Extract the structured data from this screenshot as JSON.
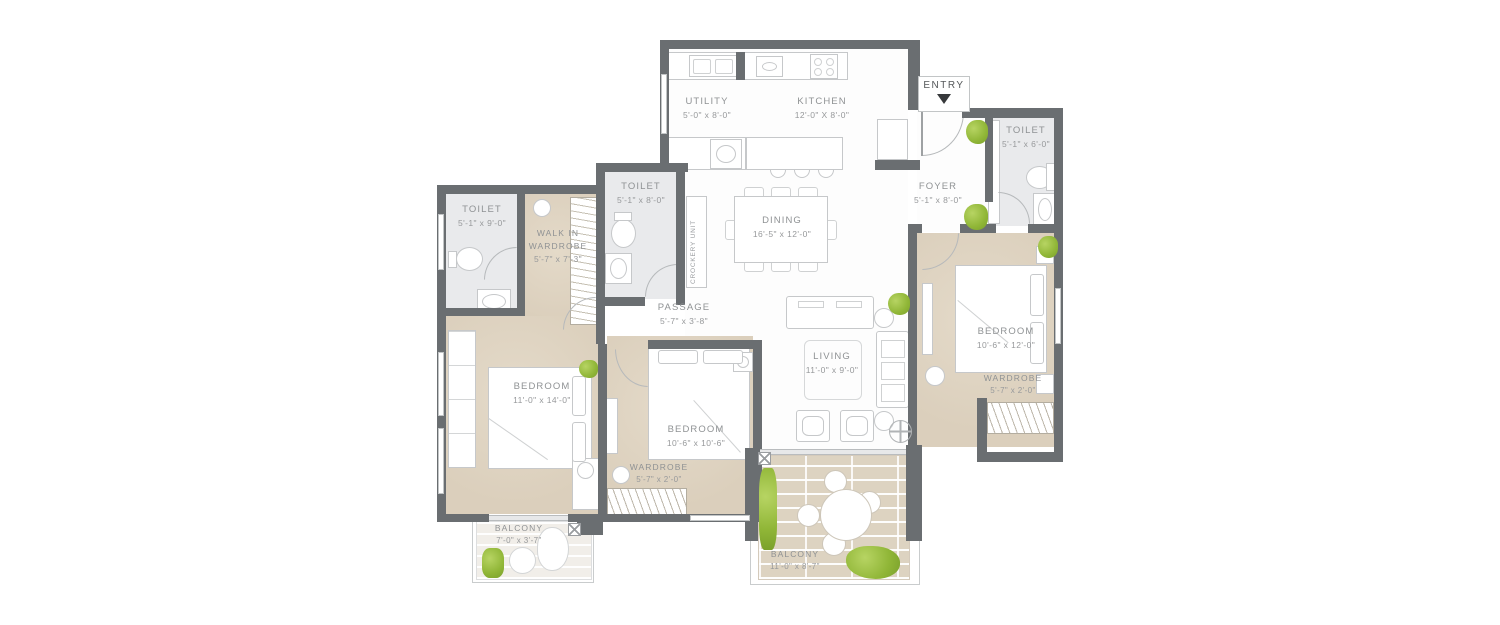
{
  "entry": {
    "label": "ENTRY"
  },
  "rooms": {
    "utility": {
      "name": "UTILITY",
      "dim": "5'-0\" x 8'-0\""
    },
    "kitchen": {
      "name": "KITCHEN",
      "dim": "12'-0\" X 8'-0\""
    },
    "foyer": {
      "name": "FOYER",
      "dim": "5'-1\" x 8'-0\""
    },
    "toilet_right": {
      "name": "TOILET",
      "dim": "5'-1\" x 6'-0\""
    },
    "toilet_mid": {
      "name": "TOILET",
      "dim": "5'-1\" x 8'-0\""
    },
    "toilet_left": {
      "name": "TOILET",
      "dim": "5'-1\" x 9'-0\""
    },
    "dining": {
      "name": "DINING",
      "dim": "16'-5\" x 12'-0\""
    },
    "crockery": {
      "name": "CROCKERY UNIT"
    },
    "passage": {
      "name": "PASSAGE",
      "dim": "5'-7\" x 3'-8\""
    },
    "living": {
      "name": "LIVING",
      "dim": "11'-0\" x 9'-0\""
    },
    "walkin": {
      "name1": "WALK IN",
      "name2": "WARDROBE",
      "dim": "5'-7\" x 7'-3\""
    },
    "bedroom_left": {
      "name": "BEDROOM",
      "dim": "11'-0\" x 14'-0\""
    },
    "bedroom_mid": {
      "name": "BEDROOM",
      "dim": "10'-6\" x 10'-6\""
    },
    "bedroom_right": {
      "name": "BEDROOM",
      "dim": "10'-6\" x 12'-0\""
    },
    "wardrobe_mid": {
      "name": "WARDROBE",
      "dim": "5'-7\" x 2'-0\""
    },
    "wardrobe_right": {
      "name": "WARDROBE",
      "dim": "5'-7\" x 2'-0\""
    },
    "balcony_left": {
      "name": "BALCONY",
      "dim": "7'-0\" x 3'-7\""
    },
    "balcony_main": {
      "name": "BALCONY",
      "dim": "11'-0\" x 8'-7\""
    }
  },
  "colors": {
    "wall": "#6a6e71",
    "floor_beige": "#ddd2c0",
    "floor_toilet": "#e9eaec",
    "deck": "#ddd3c1",
    "plant": "#90b637",
    "label_text": "#8f9294"
  }
}
